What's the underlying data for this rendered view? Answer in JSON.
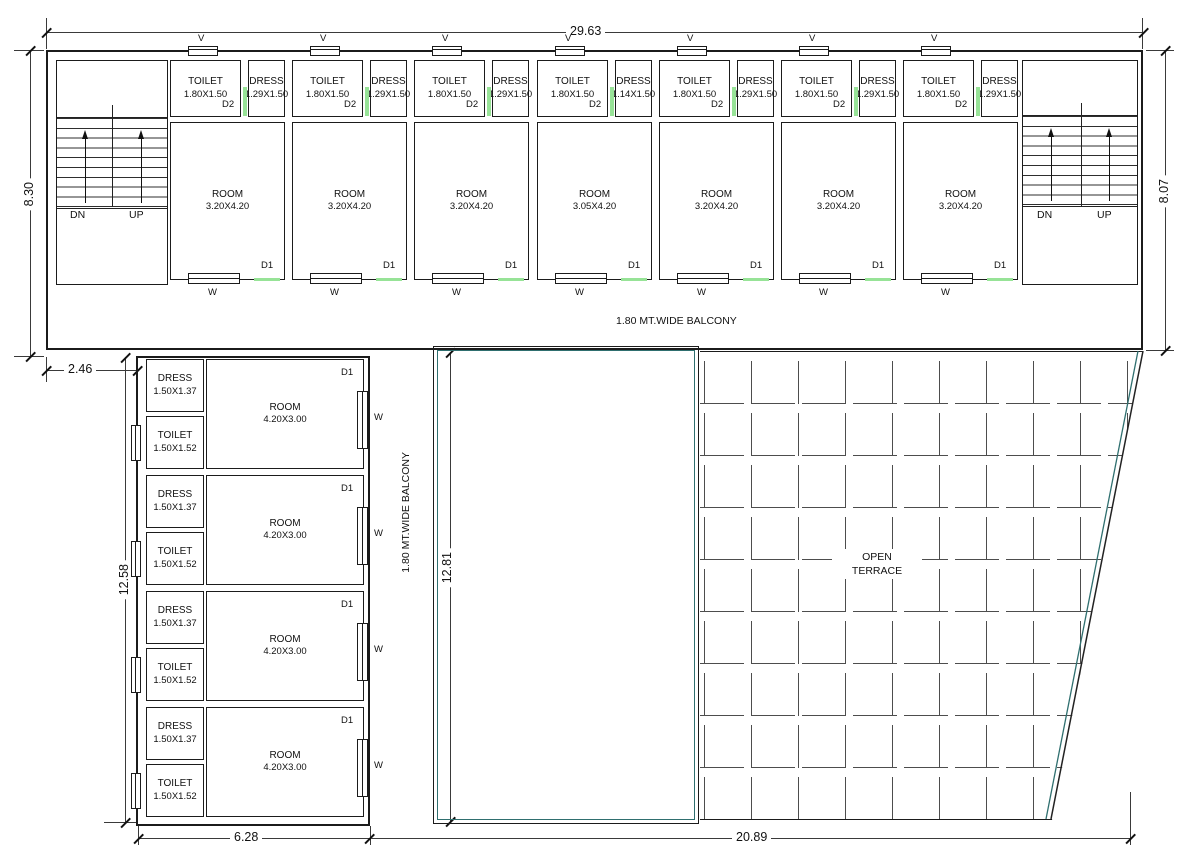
{
  "drawing": {
    "balcony_top_label": "1.80 MT.WIDE BALCONY",
    "balcony_left_label": "1.80 MT.WIDE BALCONY",
    "terrace_line1": "OPEN",
    "terrace_line2": "TERRACE",
    "vent_label": "V",
    "door1_label": "D1",
    "door2_label": "D2",
    "window_label": "W",
    "stairs": {
      "down": "DN",
      "up": "UP"
    }
  },
  "top_units": [
    {
      "toilet": "TOILET",
      "toilet_size": "1.80X1.50",
      "dress": "DRESS",
      "dress_size": "1.29X1.50",
      "room": "ROOM",
      "room_size": "3.20X4.20"
    },
    {
      "toilet": "TOILET",
      "toilet_size": "1.80X1.50",
      "dress": "DRESS",
      "dress_size": "1.29X1.50",
      "room": "ROOM",
      "room_size": "3.20X4.20"
    },
    {
      "toilet": "TOILET",
      "toilet_size": "1.80X1.50",
      "dress": "DRESS",
      "dress_size": "1.29X1.50",
      "room": "ROOM",
      "room_size": "3.20X4.20"
    },
    {
      "toilet": "TOILET",
      "toilet_size": "1.80X1.50",
      "dress": "DRESS",
      "dress_size": "1.14X1.50",
      "room": "ROOM",
      "room_size": "3.05X4.20"
    },
    {
      "toilet": "TOILET",
      "toilet_size": "1.80X1.50",
      "dress": "DRESS",
      "dress_size": "1.29X1.50",
      "room": "ROOM",
      "room_size": "3.20X4.20"
    },
    {
      "toilet": "TOILET",
      "toilet_size": "1.80X1.50",
      "dress": "DRESS",
      "dress_size": "1.29X1.50",
      "room": "ROOM",
      "room_size": "3.20X4.20"
    },
    {
      "toilet": "TOILET",
      "toilet_size": "1.80X1.50",
      "dress": "DRESS",
      "dress_size": "1.29X1.50",
      "room": "ROOM",
      "room_size": "3.20X4.20"
    }
  ],
  "left_units": [
    {
      "dress": "DRESS",
      "dress_size": "1.50X1.37",
      "toilet": "TOILET",
      "toilet_size": "1.50X1.52",
      "room": "ROOM",
      "room_size": "4.20X3.00"
    },
    {
      "dress": "DRESS",
      "dress_size": "1.50X1.37",
      "toilet": "TOILET",
      "toilet_size": "1.50X1.52",
      "room": "ROOM",
      "room_size": "4.20X3.00"
    },
    {
      "dress": "DRESS",
      "dress_size": "1.50X1.37",
      "toilet": "TOILET",
      "toilet_size": "1.50X1.52",
      "room": "ROOM",
      "room_size": "4.20X3.00"
    },
    {
      "dress": "DRESS",
      "dress_size": "1.50X1.37",
      "toilet": "TOILET",
      "toilet_size": "1.50X1.52",
      "room": "ROOM",
      "room_size": "4.20X3.00"
    }
  ],
  "dimensions": {
    "top_width": "29.63",
    "left_height": "8.30",
    "right_height": "8.07",
    "left_offset": "2.46",
    "wing_height": "12.58",
    "courtyard_height": "12.81",
    "wing_width": "6.28",
    "bottom_width": "20.89"
  },
  "colors": {
    "wall": "#1b1b1b",
    "door": "#97E397",
    "boundary": "#2F6F6F",
    "tile": "#4d4d4d"
  }
}
